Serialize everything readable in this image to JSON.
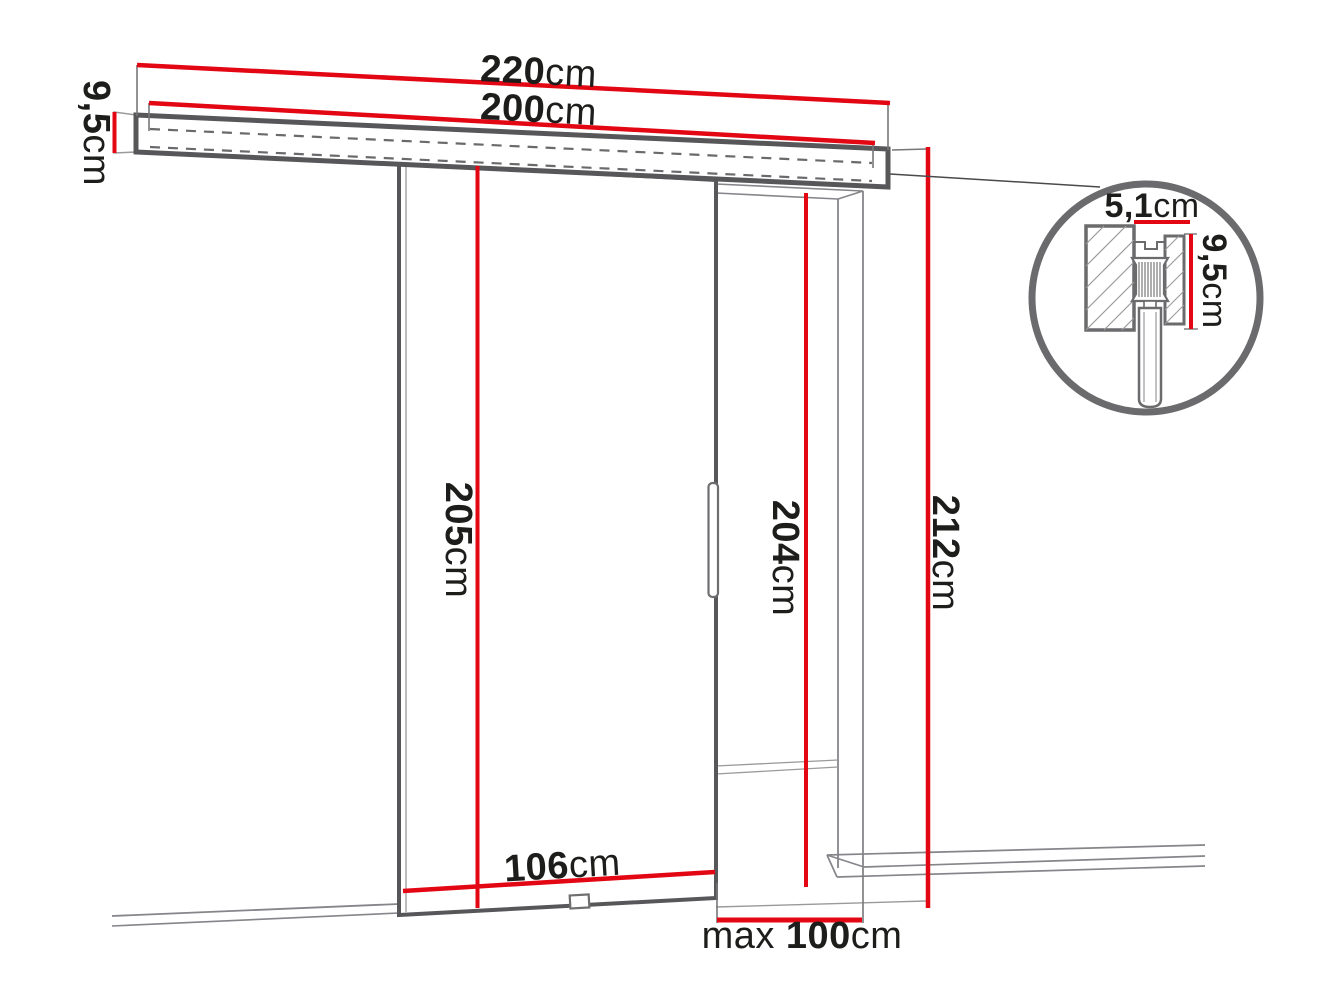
{
  "diagram": {
    "type": "technical-dimension-diagram",
    "subject": "sliding door system with wall-mounted track rail, door panel, doorway opening and track cross-section detail",
    "colors": {
      "dimension_red": "#e30613",
      "outline_gray": "#57575a",
      "thin_line_gray": "#85858a",
      "detail_gray": "#6b6b6d",
      "text_black": "#1d1d1b",
      "background": "#ffffff"
    },
    "labels": {
      "rail_total_length": {
        "value": "220",
        "unit": "cm"
      },
      "track_length": {
        "value": "200",
        "unit": "cm"
      },
      "rail_profile_height": {
        "value": "9,5",
        "unit": "cm"
      },
      "door_panel_height": {
        "value": "205",
        "unit": "cm"
      },
      "opening_height": {
        "value": "204",
        "unit": "cm"
      },
      "overall_height": {
        "value": "212",
        "unit": "cm"
      },
      "door_panel_width": {
        "value": "106",
        "unit": "cm"
      },
      "max_opening_width": {
        "prefix": "max",
        "value": "100",
        "unit": "cm"
      },
      "detail_profile_width": {
        "value": "5,1",
        "unit": "cm"
      },
      "detail_profile_height": {
        "value": "9,5",
        "unit": "cm"
      }
    }
  }
}
